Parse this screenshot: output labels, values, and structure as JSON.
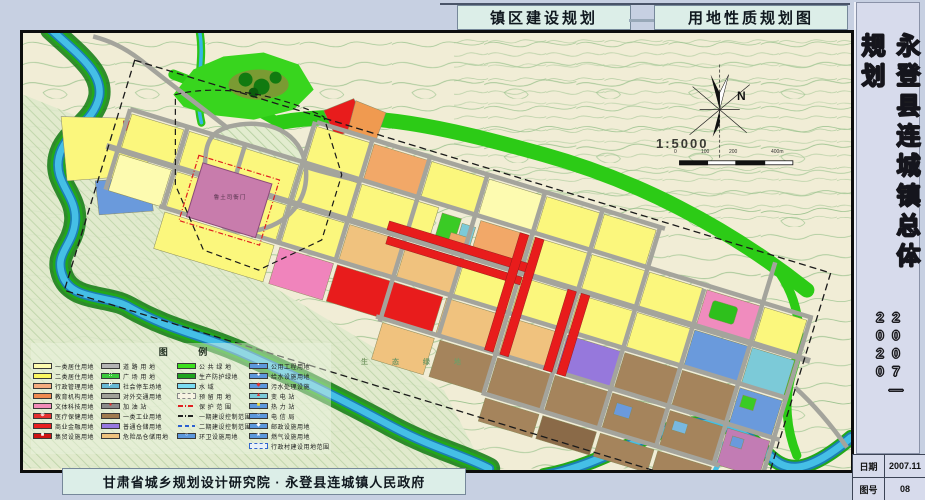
{
  "header": {
    "left_title": "镇区建设规划",
    "right_title": "用地性质规划图"
  },
  "titleblock": {
    "title_vertical": "永登县连城镇总体规划",
    "years_vertical": "2007—2020",
    "rows": [
      {
        "label": "日期",
        "value": "2007.11"
      },
      {
        "label": "图号",
        "value": "08"
      }
    ]
  },
  "footer": {
    "credit": "甘肃省城乡规划设计研究院 · 永登县连城镇人民政府"
  },
  "map": {
    "labels": {
      "landmark": "鲁土司衙门",
      "eco_green": "生 态 绿 地",
      "north": "N",
      "scale_text": "1:5000"
    },
    "scale_ticks": [
      "0",
      "100",
      "200",
      "400m"
    ]
  },
  "legend": {
    "title": "图  例",
    "columns": [
      {
        "items": [
          {
            "label": "一类居住用地",
            "kind": "solid",
            "color": "#FDFBAF"
          },
          {
            "label": "二类居住用地",
            "kind": "solid",
            "color": "#FBF760"
          },
          {
            "label": "行政管理用地",
            "kind": "solid",
            "color": "#F4AC80"
          },
          {
            "label": "教育机构用地",
            "kind": "solid",
            "color": "#F08A50"
          },
          {
            "label": "文体科技用地",
            "kind": "solid",
            "color": "#F28CB8"
          },
          {
            "label": "医疗保健用地",
            "kind": "glyph",
            "color": "#E43030",
            "glyph": "⊕",
            "glyph_color": "#FFFFFF"
          },
          {
            "label": "商业金融用地",
            "kind": "solid",
            "color": "#E82020"
          },
          {
            "label": "集贸设施用地",
            "kind": "glyph",
            "color": "#CE1414",
            "glyph": "■",
            "glyph_color": "#FFFFFF"
          }
        ]
      },
      {
        "items": [
          {
            "label": "道 路 用 地",
            "kind": "solid",
            "color": "#B4B4B4"
          },
          {
            "label": "广 场 用 地",
            "kind": "glyph",
            "color": "#3BCA3B",
            "glyph": "::",
            "glyph_color": "#FFFFFF"
          },
          {
            "label": "社会停车场地",
            "kind": "glyph",
            "color": "#66B8D6",
            "glyph": "P",
            "glyph_color": "#FFFFFF"
          },
          {
            "label": "对外交通用地",
            "kind": "solid",
            "color": "#A0A098"
          },
          {
            "label": "加 油 站",
            "kind": "glyph",
            "color": "#8A8A8A",
            "glyph": "●",
            "glyph_color": "#E43030"
          },
          {
            "label": "一类工业用地",
            "kind": "solid",
            "color": "#A07A50"
          },
          {
            "label": "普通仓储用地",
            "kind": "solid",
            "color": "#9678E0"
          },
          {
            "label": "危险品仓储用地",
            "kind": "solid",
            "color": "#EEC27E"
          }
        ]
      },
      {
        "items": [
          {
            "label": "公 共 绿 地",
            "kind": "solid",
            "color": "#3BE01E"
          },
          {
            "label": "生产防护绿地",
            "kind": "solid",
            "color": "#1FA41F"
          },
          {
            "label": "水  域",
            "kind": "solid",
            "color": "#7ADCF2"
          },
          {
            "label": "预 留 用 地",
            "kind": "dashedbox",
            "color": "#F6F3E2"
          },
          {
            "label": "保 护 范 围",
            "kind": "redline"
          },
          {
            "label": "一期建设控制范围",
            "kind": "blackline"
          },
          {
            "label": "二期建设控制范围",
            "kind": "blueline"
          },
          {
            "label": "环卫设施用地",
            "kind": "glyph",
            "color": "#5C98DC",
            "glyph": "○",
            "glyph_color": "#FFFFFF"
          }
        ]
      },
      {
        "items": [
          {
            "label": "公用工程用地",
            "kind": "glyph",
            "color": "#5C98DC",
            "glyph": "▪",
            "glyph_color": "#FFFFFF"
          },
          {
            "label": "给水设施用地",
            "kind": "glyph",
            "color": "#5C98DC",
            "glyph": "●",
            "glyph_color": "#FFFFFF"
          },
          {
            "label": "污水处理设施",
            "kind": "glyph",
            "color": "#5C98DC",
            "glyph": "◆",
            "glyph_color": "#E43030"
          },
          {
            "label": "变 电 站",
            "kind": "glyph",
            "color": "#7CCAD8",
            "glyph": "▲",
            "glyph_color": "#E43030"
          },
          {
            "label": "热 力 站",
            "kind": "glyph",
            "color": "#5C98DC",
            "glyph": "■",
            "glyph_color": "#F0E040"
          },
          {
            "label": "电 信 局",
            "kind": "glyph",
            "color": "#5C98DC",
            "glyph": "○",
            "glyph_color": "#FFFFFF"
          },
          {
            "label": "邮政设施用地",
            "kind": "glyph",
            "color": "#5C98DC",
            "glyph": "◆",
            "glyph_color": "#FFFFFF"
          },
          {
            "label": "燃气设施用地",
            "kind": "glyph",
            "color": "#5C98DC",
            "glyph": "★",
            "glyph_color": "#FFFFFF"
          },
          {
            "label": "行政村建设用地范围",
            "kind": "bluedashbox",
            "color": "#E8F0F8"
          }
        ]
      }
    ]
  }
}
